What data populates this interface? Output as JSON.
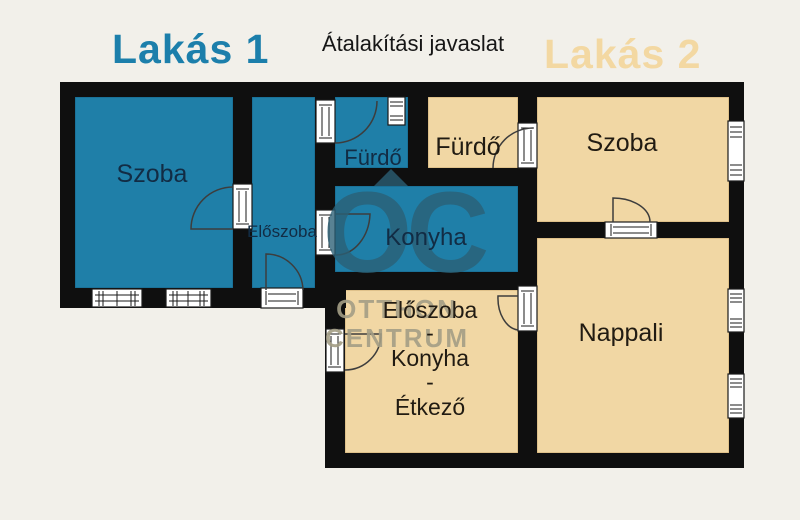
{
  "header": {
    "apartment1_title": "Lakás 1",
    "subtitle": "Átalakítási javaslat",
    "apartment2_title": "Lakás 2"
  },
  "colors": {
    "apartment1_accent": "#1c7fab",
    "apartment2_accent": "#f3d8a2",
    "room_fill_apartment1": "#1f7fa8",
    "room_fill_apartment2": "#f1d7a4",
    "wall": "#0f0f0f",
    "background": "#f2f0ea"
  },
  "watermark": {
    "monogram": "OC",
    "line1": "OTTHON",
    "line2": "CENTRUM"
  },
  "apartment1": {
    "szoba": "Szoba",
    "eloszoba": "Előszoba",
    "furdo": "Fürdő",
    "konyha": "Konyha"
  },
  "apartment2": {
    "furdo": "Fürdő",
    "szoba": "Szoba",
    "nappali": "Nappali",
    "middle_room_lines": [
      "Előszoba",
      "-",
      "Konyha",
      "-",
      "Étkező"
    ]
  }
}
